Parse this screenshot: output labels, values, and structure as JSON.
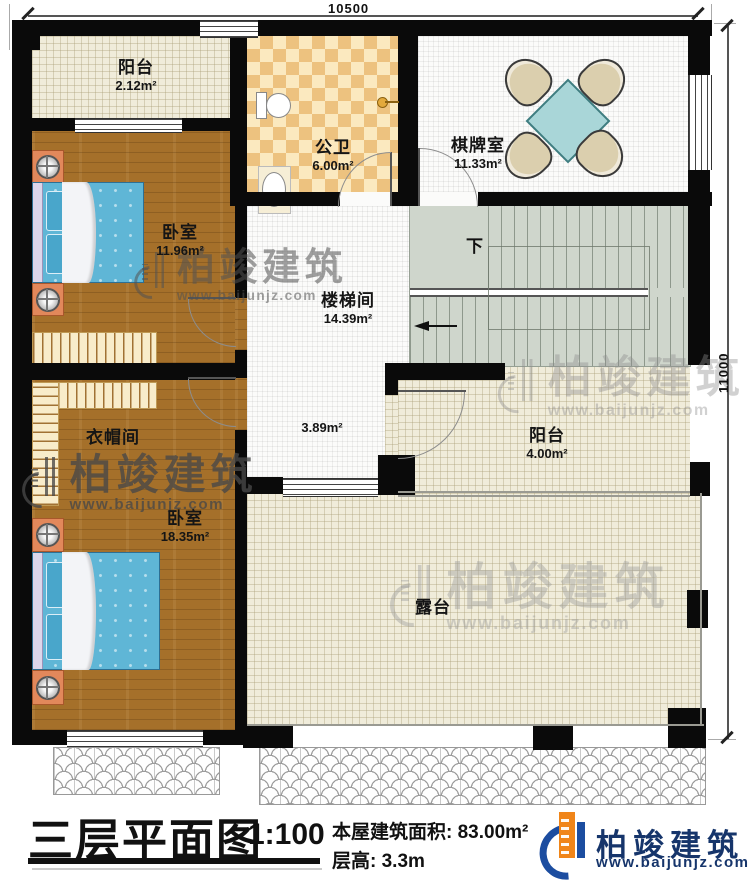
{
  "plan": {
    "dim_top": "10500",
    "dim_right": "11000",
    "down": "下",
    "rooms": {
      "balcony_top": {
        "name": "阳台",
        "area": "2.12m²"
      },
      "bathroom": {
        "name": "公卫",
        "area": "6.00m²"
      },
      "chess": {
        "name": "棋牌室",
        "area": "11.33m²"
      },
      "bedroom1": {
        "name": "卧室",
        "area": "11.96m²"
      },
      "stairwell": {
        "name": "楼梯间",
        "area": "14.39m²"
      },
      "hall": {
        "area": "3.89m²"
      },
      "cloakroom": {
        "name": "衣帽间"
      },
      "bedroom2": {
        "name": "卧室",
        "area": "18.35m²"
      },
      "balcony_south": {
        "name": "阳台",
        "area": "4.00m²"
      },
      "terrace": {
        "name": "露台"
      }
    }
  },
  "watermark": {
    "brand": "柏竣建筑",
    "url": "www.baijunjz.com"
  },
  "titleblock": {
    "title": "三层平面图",
    "scale": "1:100",
    "area_line": "本屋建筑面积: 83.00m²",
    "height_line": "层高: 3.3m",
    "brand": "柏竣建筑",
    "url": "www.baijunjz.com"
  },
  "colors": {
    "wood": "#a5702a",
    "checker_tan": "#edc27f",
    "cream": "#f0ecda",
    "stairs": "#cfd6cc",
    "brand_navy": "#16356b",
    "brand_orange": "#f08519"
  }
}
